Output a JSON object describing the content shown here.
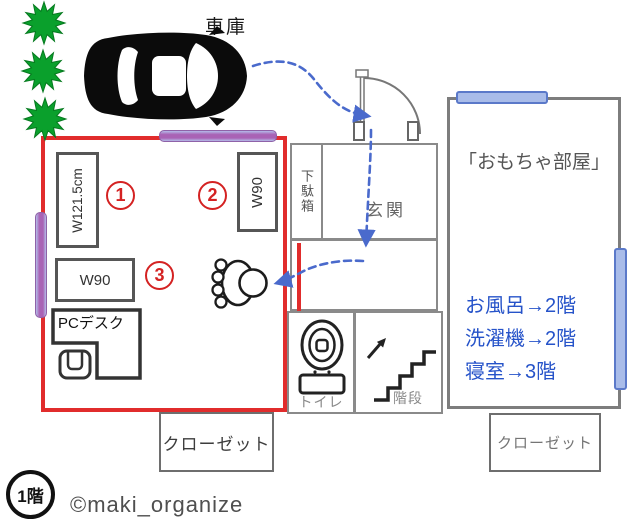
{
  "garage_label": "車庫",
  "room": {
    "items": [
      {
        "number": "1",
        "size": "W121.5cm"
      },
      {
        "number": "2",
        "size": "W90"
      },
      {
        "number": "3",
        "size": "W90"
      }
    ],
    "pc_desk": "PCデスク"
  },
  "entrance": {
    "shoe_cabinet": "下駄箱",
    "label": "玄関"
  },
  "toy_room": {
    "name": "「おもちゃ部屋」",
    "notes": [
      "お風呂→2階",
      "洗濯機→2階",
      "寝室→3階"
    ]
  },
  "toilet_label": "トイレ",
  "stairs_label": "階段",
  "closets": {
    "left": "クローゼット",
    "right": "クローゼット"
  },
  "floor_badge": "1階",
  "credit": "©maki_organize",
  "colors": {
    "room_outline": "#e12c2c",
    "window_purple": "#a963b5",
    "window_blue": "#a9bce9",
    "window_blue_border": "#5b79c9",
    "path_arrow": "#4a6acc",
    "note_text": "#2653c9",
    "star_green": "#0aa02c"
  }
}
